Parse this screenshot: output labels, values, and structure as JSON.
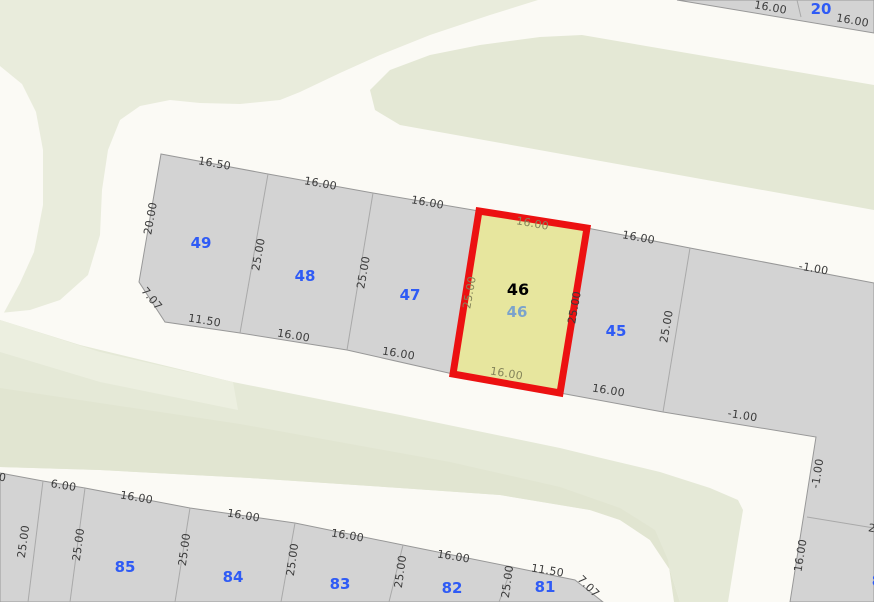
{
  "map": {
    "canvas": {
      "width": 874,
      "height": 602
    },
    "colors": {
      "road": "#fbfaf5",
      "green_top_left": "#e9ecdc",
      "green_top_right": "#e4e8d5",
      "green_middle": "#e5e9d7",
      "green_middle_dark": "#e1e5d1",
      "green_middle_light": "#ecefe0",
      "block_fill": "#d3d3d3",
      "block_stroke": "#989898",
      "boundary_line": "#a9a9a9",
      "selected_fill": "#e7e69e",
      "selected_stroke": "#ec1111",
      "dim_text": "#3b3b3b",
      "dim_text_selected": "#84845a",
      "parcel_number": "#2f5bf5",
      "selected_number_primary": "#000000",
      "selected_number_secondary": "#7ba3cc"
    },
    "green_regions": [
      {
        "name": "green-area-top-left",
        "color_key": "green_top_left",
        "points": [
          [
            0,
            0
          ],
          [
            538,
            0
          ],
          [
            490,
            15
          ],
          [
            430,
            35
          ],
          [
            380,
            55
          ],
          [
            340,
            73
          ],
          [
            300,
            92
          ],
          [
            280,
            100
          ],
          [
            240,
            104
          ],
          [
            200,
            103
          ],
          [
            170,
            100
          ],
          [
            140,
            106
          ],
          [
            120,
            120
          ],
          [
            108,
            150
          ],
          [
            102,
            190
          ],
          [
            100,
            235
          ],
          [
            88,
            275
          ],
          [
            60,
            300
          ],
          [
            30,
            310
          ],
          [
            0,
            313
          ]
        ]
      },
      {
        "name": "green-area-top-right",
        "color_key": "green_top_right",
        "points": [
          [
            582,
            35
          ],
          [
            874,
            85
          ],
          [
            874,
            210
          ],
          [
            400,
            125
          ],
          [
            375,
            110
          ],
          [
            370,
            90
          ],
          [
            390,
            70
          ],
          [
            430,
            55
          ],
          [
            480,
            45
          ],
          [
            540,
            37
          ]
        ]
      },
      {
        "name": "green-area-middle",
        "color_key": "green_middle",
        "points": [
          [
            0,
            320
          ],
          [
            80,
            345
          ],
          [
            233,
            382
          ],
          [
            400,
            415
          ],
          [
            560,
            448
          ],
          [
            597,
            457
          ],
          [
            660,
            472
          ],
          [
            710,
            488
          ],
          [
            738,
            500
          ],
          [
            743,
            510
          ],
          [
            738,
            540
          ],
          [
            728,
            602
          ],
          [
            680,
            602
          ],
          [
            670,
            570
          ],
          [
            650,
            540
          ],
          [
            620,
            520
          ],
          [
            590,
            510
          ],
          [
            500,
            495
          ],
          [
            400,
            488
          ],
          [
            250,
            478
          ],
          [
            100,
            470
          ],
          [
            0,
            467
          ]
        ]
      },
      {
        "name": "green-area-middle-dark-band",
        "color_key": "green_middle_dark",
        "points": [
          [
            0,
            388
          ],
          [
            240,
            424
          ],
          [
            450,
            462
          ],
          [
            560,
            487
          ],
          [
            620,
            508
          ],
          [
            655,
            530
          ],
          [
            668,
            560
          ],
          [
            674,
            602
          ],
          [
            680,
            602
          ],
          [
            670,
            570
          ],
          [
            650,
            540
          ],
          [
            620,
            520
          ],
          [
            590,
            510
          ],
          [
            500,
            495
          ],
          [
            400,
            488
          ],
          [
            250,
            478
          ],
          [
            100,
            470
          ],
          [
            0,
            467
          ]
        ]
      },
      {
        "name": "green-area-middle-light-corner",
        "color_key": "green_middle_light",
        "points": [
          [
            0,
            320
          ],
          [
            100,
            352
          ],
          [
            233,
            382
          ],
          [
            238,
            410
          ],
          [
            100,
            382
          ],
          [
            0,
            352
          ]
        ]
      }
    ],
    "road_patch": {
      "name": "road-stub-left-edge",
      "points": [
        [
          0,
          66
        ],
        [
          22,
          84
        ],
        [
          36,
          112
        ],
        [
          43,
          150
        ],
        [
          43,
          205
        ],
        [
          34,
          252
        ],
        [
          20,
          283
        ],
        [
          0,
          320
        ]
      ]
    },
    "blocks": [
      {
        "name": "block-upper",
        "points": [
          [
            161,
            154
          ],
          [
            268,
            174
          ],
          [
            373,
            193
          ],
          [
            479,
            211
          ],
          [
            587,
            228
          ],
          [
            690,
            248
          ],
          [
            874,
            283
          ],
          [
            874,
            602
          ],
          [
            790,
            602
          ],
          [
            816,
            437
          ],
          [
            663,
            412
          ],
          [
            560,
            393
          ],
          [
            453,
            374
          ],
          [
            347,
            350
          ],
          [
            240,
            333
          ],
          [
            165,
            322
          ],
          [
            139,
            282
          ]
        ]
      },
      {
        "name": "block-lower",
        "points": [
          [
            0,
            473
          ],
          [
            43,
            481
          ],
          [
            85,
            488
          ],
          [
            190,
            508
          ],
          [
            295,
            523
          ],
          [
            403,
            545
          ],
          [
            512,
            567
          ],
          [
            575,
            580
          ],
          [
            603,
            602
          ],
          [
            0,
            602
          ]
        ]
      },
      {
        "name": "block-top-right-strip",
        "points": [
          [
            677,
            0
          ],
          [
            874,
            0
          ],
          [
            874,
            33
          ]
        ]
      }
    ],
    "inner_boundaries": [
      {
        "name": "lot-line-49-48",
        "x1": 268,
        "y1": 174,
        "x2": 240,
        "y2": 333
      },
      {
        "name": "lot-line-48-47",
        "x1": 373,
        "y1": 193,
        "x2": 347,
        "y2": 350
      },
      {
        "name": "lot-line-45-left",
        "x1": 587,
        "y1": 228,
        "x2": 560,
        "y2": 393
      },
      {
        "name": "lot-line-45-right",
        "x1": 690,
        "y1": 248,
        "x2": 663,
        "y2": 412
      },
      {
        "name": "lot-line-right-strip",
        "x1": 807,
        "y1": 517,
        "x2": 874,
        "y2": 528
      },
      {
        "name": "lot-line-top-strip",
        "x1": 797,
        "y1": 0,
        "x2": 801,
        "y2": 17
      },
      {
        "name": "lot-line-low-1",
        "x1": 43,
        "y1": 481,
        "x2": 28,
        "y2": 602
      },
      {
        "name": "lot-line-low-2",
        "x1": 85,
        "y1": 488,
        "x2": 70,
        "y2": 602
      },
      {
        "name": "lot-line-low-3",
        "x1": 190,
        "y1": 508,
        "x2": 175,
        "y2": 602
      },
      {
        "name": "lot-line-low-4",
        "x1": 295,
        "y1": 523,
        "x2": 281,
        "y2": 602
      },
      {
        "name": "lot-line-low-5",
        "x1": 403,
        "y1": 545,
        "x2": 389,
        "y2": 602
      },
      {
        "name": "lot-line-low-6",
        "x1": 512,
        "y1": 567,
        "x2": 499,
        "y2": 602
      }
    ],
    "selected_parcel": {
      "name": "parcel-46-selected",
      "points": [
        [
          479,
          211
        ],
        [
          587,
          228
        ],
        [
          560,
          393
        ],
        [
          453,
          374
        ]
      ],
      "number_primary": {
        "text": "46",
        "x": 518,
        "y": 295
      },
      "number_secondary": {
        "text": "46",
        "x": 517,
        "y": 317
      }
    },
    "dimension_labels": [
      {
        "text": "16.50",
        "x": 214,
        "y": 167,
        "rot": 10
      },
      {
        "text": "16.00",
        "x": 320,
        "y": 187,
        "rot": 10
      },
      {
        "text": "16.00",
        "x": 427,
        "y": 206,
        "rot": 10
      },
      {
        "text": "16.00",
        "x": 532,
        "y": 227,
        "rot": 10,
        "tone": "selected"
      },
      {
        "text": "16.00",
        "x": 638,
        "y": 241,
        "rot": 10
      },
      {
        "text": "-1.00",
        "x": 813,
        "y": 272,
        "rot": 10
      },
      {
        "text": "20.00",
        "x": 154,
        "y": 219,
        "rot": -80
      },
      {
        "text": "7.07",
        "x": 149,
        "y": 301,
        "rot": 50
      },
      {
        "text": "11.50",
        "x": 204,
        "y": 324,
        "rot": 9
      },
      {
        "text": "16.00",
        "x": 293,
        "y": 339,
        "rot": 9
      },
      {
        "text": "16.00",
        "x": 398,
        "y": 357,
        "rot": 9
      },
      {
        "text": "16.00",
        "x": 506,
        "y": 377,
        "rot": 9,
        "tone": "selected"
      },
      {
        "text": "16.00",
        "x": 608,
        "y": 394,
        "rot": 9
      },
      {
        "text": "-1.00",
        "x": 742,
        "y": 419,
        "rot": 9
      },
      {
        "text": "25.00",
        "x": 262,
        "y": 255,
        "rot": -80
      },
      {
        "text": "25.00",
        "x": 367,
        "y": 273,
        "rot": -80
      },
      {
        "text": "25.00",
        "x": 473,
        "y": 293,
        "rot": -80,
        "tone": "selected"
      },
      {
        "text": "25.00",
        "x": 578,
        "y": 308,
        "rot": -80
      },
      {
        "text": "25.00",
        "x": 670,
        "y": 327,
        "rot": -80
      },
      {
        "text": "-1.00",
        "x": 821,
        "y": 474,
        "rot": -81
      },
      {
        "text": "16.00",
        "x": 804,
        "y": 556,
        "rot": -81
      },
      {
        "text": "25.00",
        "x": 884,
        "y": 534,
        "rot": 10
      },
      {
        "text": "16.00",
        "x": 770,
        "y": 11,
        "rot": 10
      },
      {
        "text": "16.00",
        "x": 852,
        "y": 24,
        "rot": 10
      },
      {
        "text": "0",
        "x": 2,
        "y": 481,
        "rot": 9
      },
      {
        "text": "6.00",
        "x": 63,
        "y": 489,
        "rot": 9
      },
      {
        "text": "16.00",
        "x": 136,
        "y": 501,
        "rot": 9
      },
      {
        "text": "16.00",
        "x": 243,
        "y": 519,
        "rot": 9
      },
      {
        "text": "16.00",
        "x": 347,
        "y": 539,
        "rot": 9
      },
      {
        "text": "16.00",
        "x": 453,
        "y": 560,
        "rot": 9
      },
      {
        "text": "11.50",
        "x": 547,
        "y": 574,
        "rot": 9
      },
      {
        "text": "7.07",
        "x": 586,
        "y": 589,
        "rot": 45
      },
      {
        "text": "25.00",
        "x": 27,
        "y": 542,
        "rot": -82
      },
      {
        "text": "25.00",
        "x": 82,
        "y": 545,
        "rot": -82
      },
      {
        "text": "25.00",
        "x": 188,
        "y": 550,
        "rot": -82
      },
      {
        "text": "25.00",
        "x": 296,
        "y": 560,
        "rot": -82
      },
      {
        "text": "25.00",
        "x": 404,
        "y": 572,
        "rot": -82
      },
      {
        "text": "25.00",
        "x": 511,
        "y": 582,
        "rot": -82
      }
    ],
    "parcel_numbers": [
      {
        "text": "49",
        "x": 201,
        "y": 248
      },
      {
        "text": "48",
        "x": 305,
        "y": 281
      },
      {
        "text": "47",
        "x": 410,
        "y": 300
      },
      {
        "text": "45",
        "x": 616,
        "y": 336
      },
      {
        "text": "20",
        "x": 821,
        "y": 14
      },
      {
        "text": "85",
        "x": 125,
        "y": 572
      },
      {
        "text": "84",
        "x": 233,
        "y": 582
      },
      {
        "text": "83",
        "x": 340,
        "y": 589
      },
      {
        "text": "82",
        "x": 452,
        "y": 593
      },
      {
        "text": "81",
        "x": 545,
        "y": 592
      },
      {
        "text": "8",
        "x": 877,
        "y": 586
      }
    ]
  }
}
